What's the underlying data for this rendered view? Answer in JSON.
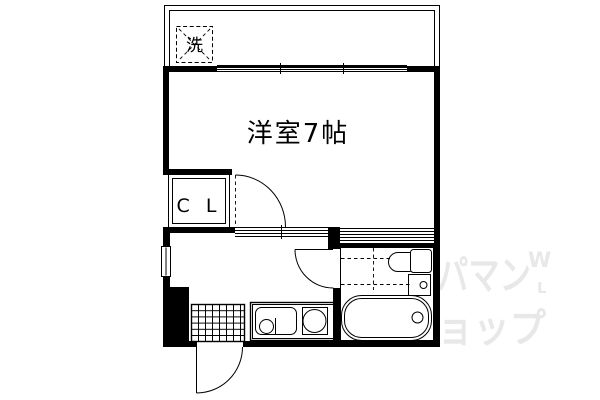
{
  "floor_plan": {
    "main_room": {
      "label": "洋室7帖"
    },
    "closet": {
      "label": "C L"
    },
    "balcony": {
      "washer_box_label": "洗"
    },
    "watermark": {
      "line1": "パマン",
      "line2": "ョップ",
      "mark_top": "W",
      "mark_mid": "L",
      "color": "#e8e8e8"
    },
    "colors": {
      "line": "#000000",
      "background": "#ffffff"
    }
  }
}
